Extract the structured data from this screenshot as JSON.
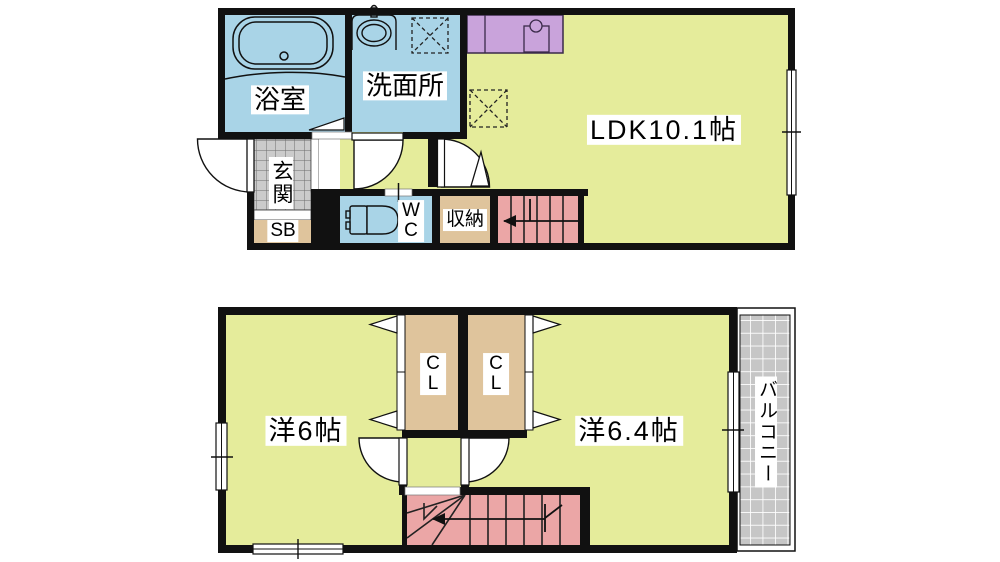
{
  "plan": {
    "floor1": {
      "bath_label": "浴室",
      "washroom_label": "洗面所",
      "ldk_label": "LDK10.1帖",
      "entrance_label": "玄関",
      "shoebox_label": "SB",
      "wc_label": "WC",
      "storage_label": "収納"
    },
    "floor2": {
      "room6_label": "洋6帖",
      "closet1_label": "CL",
      "closet2_label": "CL",
      "room64_label": "洋6.4帖",
      "balcony_label": "バルコニー"
    },
    "colors": {
      "room_fill": "#E5EC9B",
      "wet_area_fill": "#A9D4E7",
      "stairs_fill": "#EBA6A6",
      "closet_fill": "#DFC49C",
      "kitchen_fill": "#C9A3DB",
      "entrance_tile_fill": "#CBCBCB",
      "balcony_tile_fill": "#C6C6C6",
      "wall_color": "#111111"
    }
  }
}
